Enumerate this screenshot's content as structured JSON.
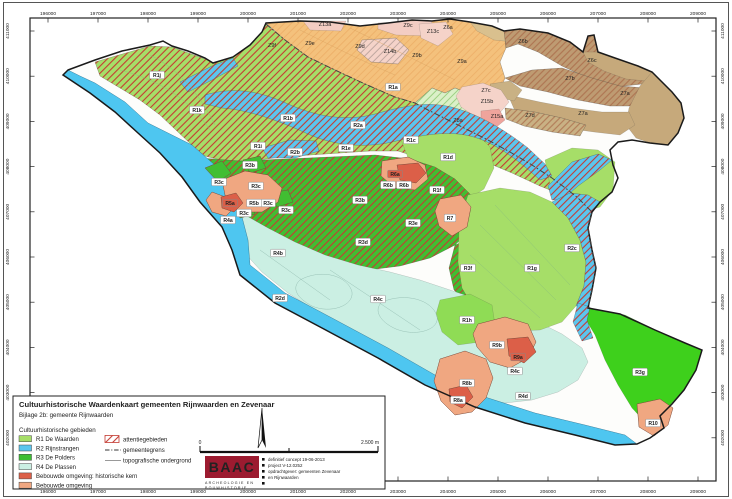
{
  "map": {
    "axis": {
      "x_ticks": [
        "196000",
        "197000",
        "198000",
        "199000",
        "200000",
        "201000",
        "202000",
        "203000",
        "204000",
        "205000",
        "206000",
        "207000",
        "208000",
        "209000"
      ],
      "y_ticks": [
        "411000",
        "410000",
        "409000",
        "408000",
        "407000",
        "406000",
        "405000",
        "404000",
        "403000",
        "402000"
      ]
    },
    "region_labels": [
      {
        "id": "R1j",
        "x": 157,
        "y": 75,
        "t": "w"
      },
      {
        "id": "R1k",
        "x": 197,
        "y": 110,
        "t": "w"
      },
      {
        "id": "R1b",
        "x": 288,
        "y": 118,
        "t": "w"
      },
      {
        "id": "R1a",
        "x": 393,
        "y": 87,
        "t": "w"
      },
      {
        "id": "R1c",
        "x": 411,
        "y": 140,
        "t": "w"
      },
      {
        "id": "R1d",
        "x": 448,
        "y": 157,
        "t": "w"
      },
      {
        "id": "R1e",
        "x": 346,
        "y": 148,
        "t": "w"
      },
      {
        "id": "R1f",
        "x": 437,
        "y": 190,
        "t": "w"
      },
      {
        "id": "R1g",
        "x": 532,
        "y": 268,
        "t": "w"
      },
      {
        "id": "R1h",
        "x": 467,
        "y": 320,
        "t": "w"
      },
      {
        "id": "R1i",
        "x": 258,
        "y": 146,
        "t": "w"
      },
      {
        "id": "R2a",
        "x": 358,
        "y": 125,
        "t": "w"
      },
      {
        "id": "R2b",
        "x": 295,
        "y": 152,
        "t": "w"
      },
      {
        "id": "R2c",
        "x": 572,
        "y": 248,
        "t": "w"
      },
      {
        "id": "R2d",
        "x": 280,
        "y": 298,
        "t": "w"
      },
      {
        "id": "R3b",
        "x": 250,
        "y": 165,
        "t": "w"
      },
      {
        "id": "R3b",
        "x": 360,
        "y": 200,
        "t": "w"
      },
      {
        "id": "R3c",
        "x": 219,
        "y": 182,
        "t": "w"
      },
      {
        "id": "R3c",
        "x": 256,
        "y": 186,
        "t": "w"
      },
      {
        "id": "R3c",
        "x": 268,
        "y": 203,
        "t": "w"
      },
      {
        "id": "R3c",
        "x": 286,
        "y": 210,
        "t": "w"
      },
      {
        "id": "R3c",
        "x": 244,
        "y": 213,
        "t": "w"
      },
      {
        "id": "R3d",
        "x": 363,
        "y": 242,
        "t": "w"
      },
      {
        "id": "R3e",
        "x": 413,
        "y": 223,
        "t": "w"
      },
      {
        "id": "R3f",
        "x": 468,
        "y": 268,
        "t": "w"
      },
      {
        "id": "R3g",
        "x": 640,
        "y": 372,
        "t": "w"
      },
      {
        "id": "R4a",
        "x": 228,
        "y": 220,
        "t": "w"
      },
      {
        "id": "R4b",
        "x": 278,
        "y": 253,
        "t": "w"
      },
      {
        "id": "R4c",
        "x": 378,
        "y": 299,
        "t": "w"
      },
      {
        "id": "R4c",
        "x": 515,
        "y": 371,
        "t": "w"
      },
      {
        "id": "R4d",
        "x": 523,
        "y": 396,
        "t": "w"
      },
      {
        "id": "R5a",
        "x": 230,
        "y": 203,
        "t": "r"
      },
      {
        "id": "R5b",
        "x": 254,
        "y": 203,
        "t": "w"
      },
      {
        "id": "R6a",
        "x": 395,
        "y": 174,
        "t": "r"
      },
      {
        "id": "R6b",
        "x": 388,
        "y": 185,
        "t": "w"
      },
      {
        "id": "R6b",
        "x": 404,
        "y": 185,
        "t": "w"
      },
      {
        "id": "R7",
        "x": 450,
        "y": 218,
        "t": "w"
      },
      {
        "id": "R8a",
        "x": 458,
        "y": 400,
        "t": "w"
      },
      {
        "id": "R8b",
        "x": 467,
        "y": 383,
        "t": "w"
      },
      {
        "id": "R9a",
        "x": 518,
        "y": 357,
        "t": "r"
      },
      {
        "id": "R9b",
        "x": 497,
        "y": 345,
        "t": "w"
      },
      {
        "id": "R10",
        "x": 653,
        "y": 423,
        "t": "w"
      },
      {
        "id": "Z9f",
        "x": 272,
        "y": 47,
        "t": "z"
      },
      {
        "id": "Z9e",
        "x": 310,
        "y": 45,
        "t": "z"
      },
      {
        "id": "Z9d",
        "x": 360,
        "y": 48,
        "t": "z"
      },
      {
        "id": "Z9c",
        "x": 408,
        "y": 27,
        "t": "z"
      },
      {
        "id": "Z9b",
        "x": 417,
        "y": 57,
        "t": "z"
      },
      {
        "id": "Z9a",
        "x": 462,
        "y": 63,
        "t": "z"
      },
      {
        "id": "Z13a",
        "x": 325,
        "y": 26,
        "t": "z"
      },
      {
        "id": "Z13c",
        "x": 433,
        "y": 33,
        "t": "z"
      },
      {
        "id": "Z14b",
        "x": 390,
        "y": 53,
        "t": "z"
      },
      {
        "id": "Z15b",
        "x": 487,
        "y": 103,
        "t": "z"
      },
      {
        "id": "Z15a",
        "x": 497,
        "y": 118,
        "t": "z"
      },
      {
        "id": "Z6a",
        "x": 448,
        "y": 29,
        "t": "z"
      },
      {
        "id": "Z6b",
        "x": 523,
        "y": 43,
        "t": "z"
      },
      {
        "id": "Z6c",
        "x": 592,
        "y": 62,
        "t": "z"
      },
      {
        "id": "Z7b",
        "x": 570,
        "y": 80,
        "t": "z"
      },
      {
        "id": "Z7a",
        "x": 625,
        "y": 95,
        "t": "z"
      },
      {
        "id": "Z7a",
        "x": 583,
        "y": 115,
        "t": "z"
      },
      {
        "id": "Z7c",
        "x": 486,
        "y": 92,
        "t": "z"
      },
      {
        "id": "Z7d",
        "x": 530,
        "y": 117,
        "t": "z"
      },
      {
        "id": "Z8a",
        "x": 458,
        "y": 122,
        "t": "z"
      }
    ]
  },
  "legend": {
    "title": "Cultuurhistorische Waardenkaart gemeenten Rijnwaarden en Zevenaar",
    "subtitle": "Bijlage 2b: gemeente Rijnwaarden",
    "group_title": "Cultuurhistorische gebieden",
    "items": [
      {
        "label": "R1 De Waarden",
        "color": "#A6DE68"
      },
      {
        "label": "R2 Rijnstrangen",
        "color": "#5BC6EE"
      },
      {
        "label": "R3 De Polders",
        "color": "#3DBE33"
      },
      {
        "label": "R4 De Plassen",
        "color": "#CBEFE3"
      },
      {
        "label": "Bebouwde omgeving: historische kern",
        "color": "#DC5F48"
      },
      {
        "label": "Bebouwde omgeving",
        "color": "#F0A781"
      }
    ],
    "overlay_items": [
      {
        "label": "attentiegebieden",
        "type": "hatch"
      },
      {
        "label": "gemeentegrens",
        "type": "dashdot"
      },
      {
        "label": "topografische ondergrond",
        "type": "line"
      }
    ],
    "scalebar": {
      "start": "0",
      "end": "2.500 m"
    },
    "north_arrow": "N",
    "credits": {
      "logo": "BAAC",
      "logo_sub1": "ARCHEOLOGIE EN",
      "logo_sub2": "BOUWHISTORIE",
      "lines": [
        "definitief concept 19-06-2013",
        "project V-12.0252",
        "opdrachtgever: gemeenten Zevenaar",
        "en Rijnwaarden"
      ]
    }
  },
  "colors": {
    "r1": "#A6DE68",
    "r2": "#5BC6EE",
    "r3": "#41BE32",
    "r3_bright": "#3ED01C",
    "r4": "#CBEFE3",
    "kern": "#DC5F48",
    "bebouwd": "#F0A781",
    "river": "#4EC6F0",
    "orange": "#F4C17C",
    "pink": "#F5D3C9",
    "pink2": "#F3CDC3",
    "salmonpink": "#EFA49C",
    "tan": "#C6A97B",
    "tan_light": "#D9C08E",
    "brown": "#BE9B72",
    "olive": "#C9B184",
    "zgreen": "#DBF0C8",
    "hatchred": "#C43B32",
    "hatchbrown": "#A5603F",
    "hatchorange": "#E8A259",
    "hatchgreen": "#8CC870",
    "hatchgray": "#C0A8A0",
    "outline": "#1A1A1A",
    "grens": "#444444",
    "parcel": "#93BCB1",
    "logo_red": "#9C1B30"
  }
}
